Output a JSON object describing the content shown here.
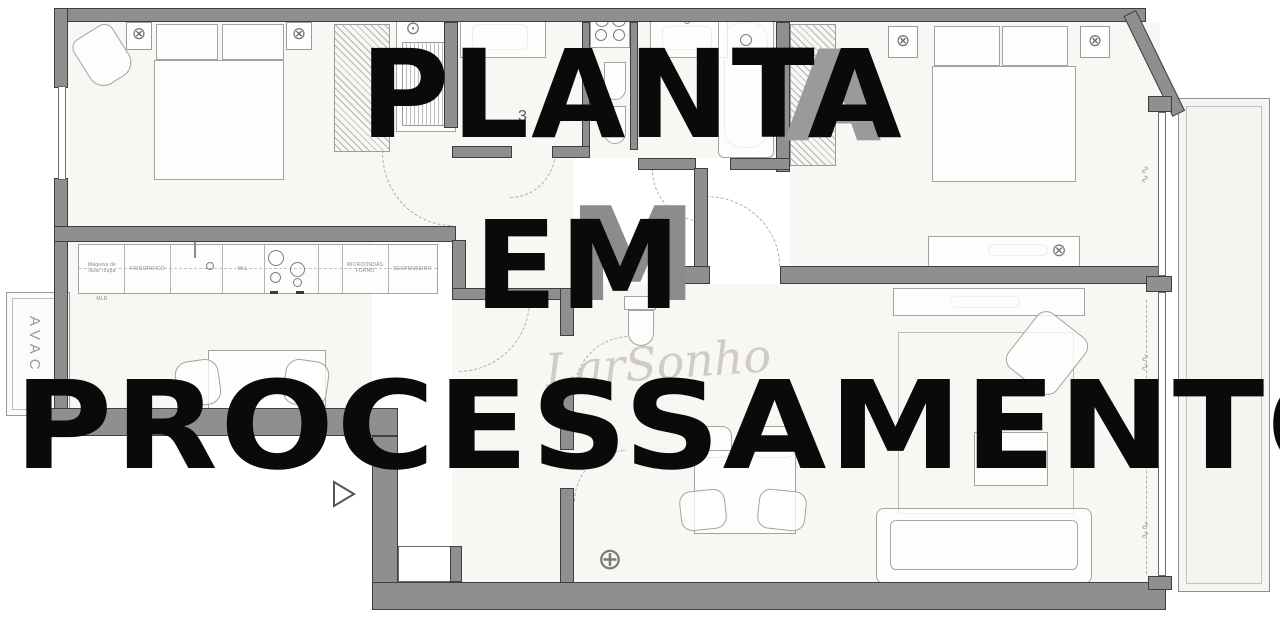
{
  "watermark": {
    "line1": "PLANTA",
    "line2": "EM",
    "line3": "PROCESSAMENTO",
    "echo_m": "M",
    "echo_a": "A",
    "brand_script": "LarSonho"
  },
  "plan": {
    "avac_label": "AVAC",
    "kitchen": {
      "washer_line1": "Máquina de",
      "washer_line2": "lavar roupa",
      "washer_sub": "MLR",
      "fridge": "FRIGORÍFICO",
      "dishwasher": "MLL",
      "microwave_line1": "MICROONDAS",
      "microwave_line2": "FORNO",
      "pantry": "DESPENSEIRO"
    },
    "areas": {
      "bath1_fragment": "3",
      "bath2_fragment_a": "3,",
      "bath2_fragment_b": "2"
    }
  },
  "icons": {
    "sconce": "⊗",
    "ceiling_light": "⊕",
    "shower_head": "⊙"
  }
}
